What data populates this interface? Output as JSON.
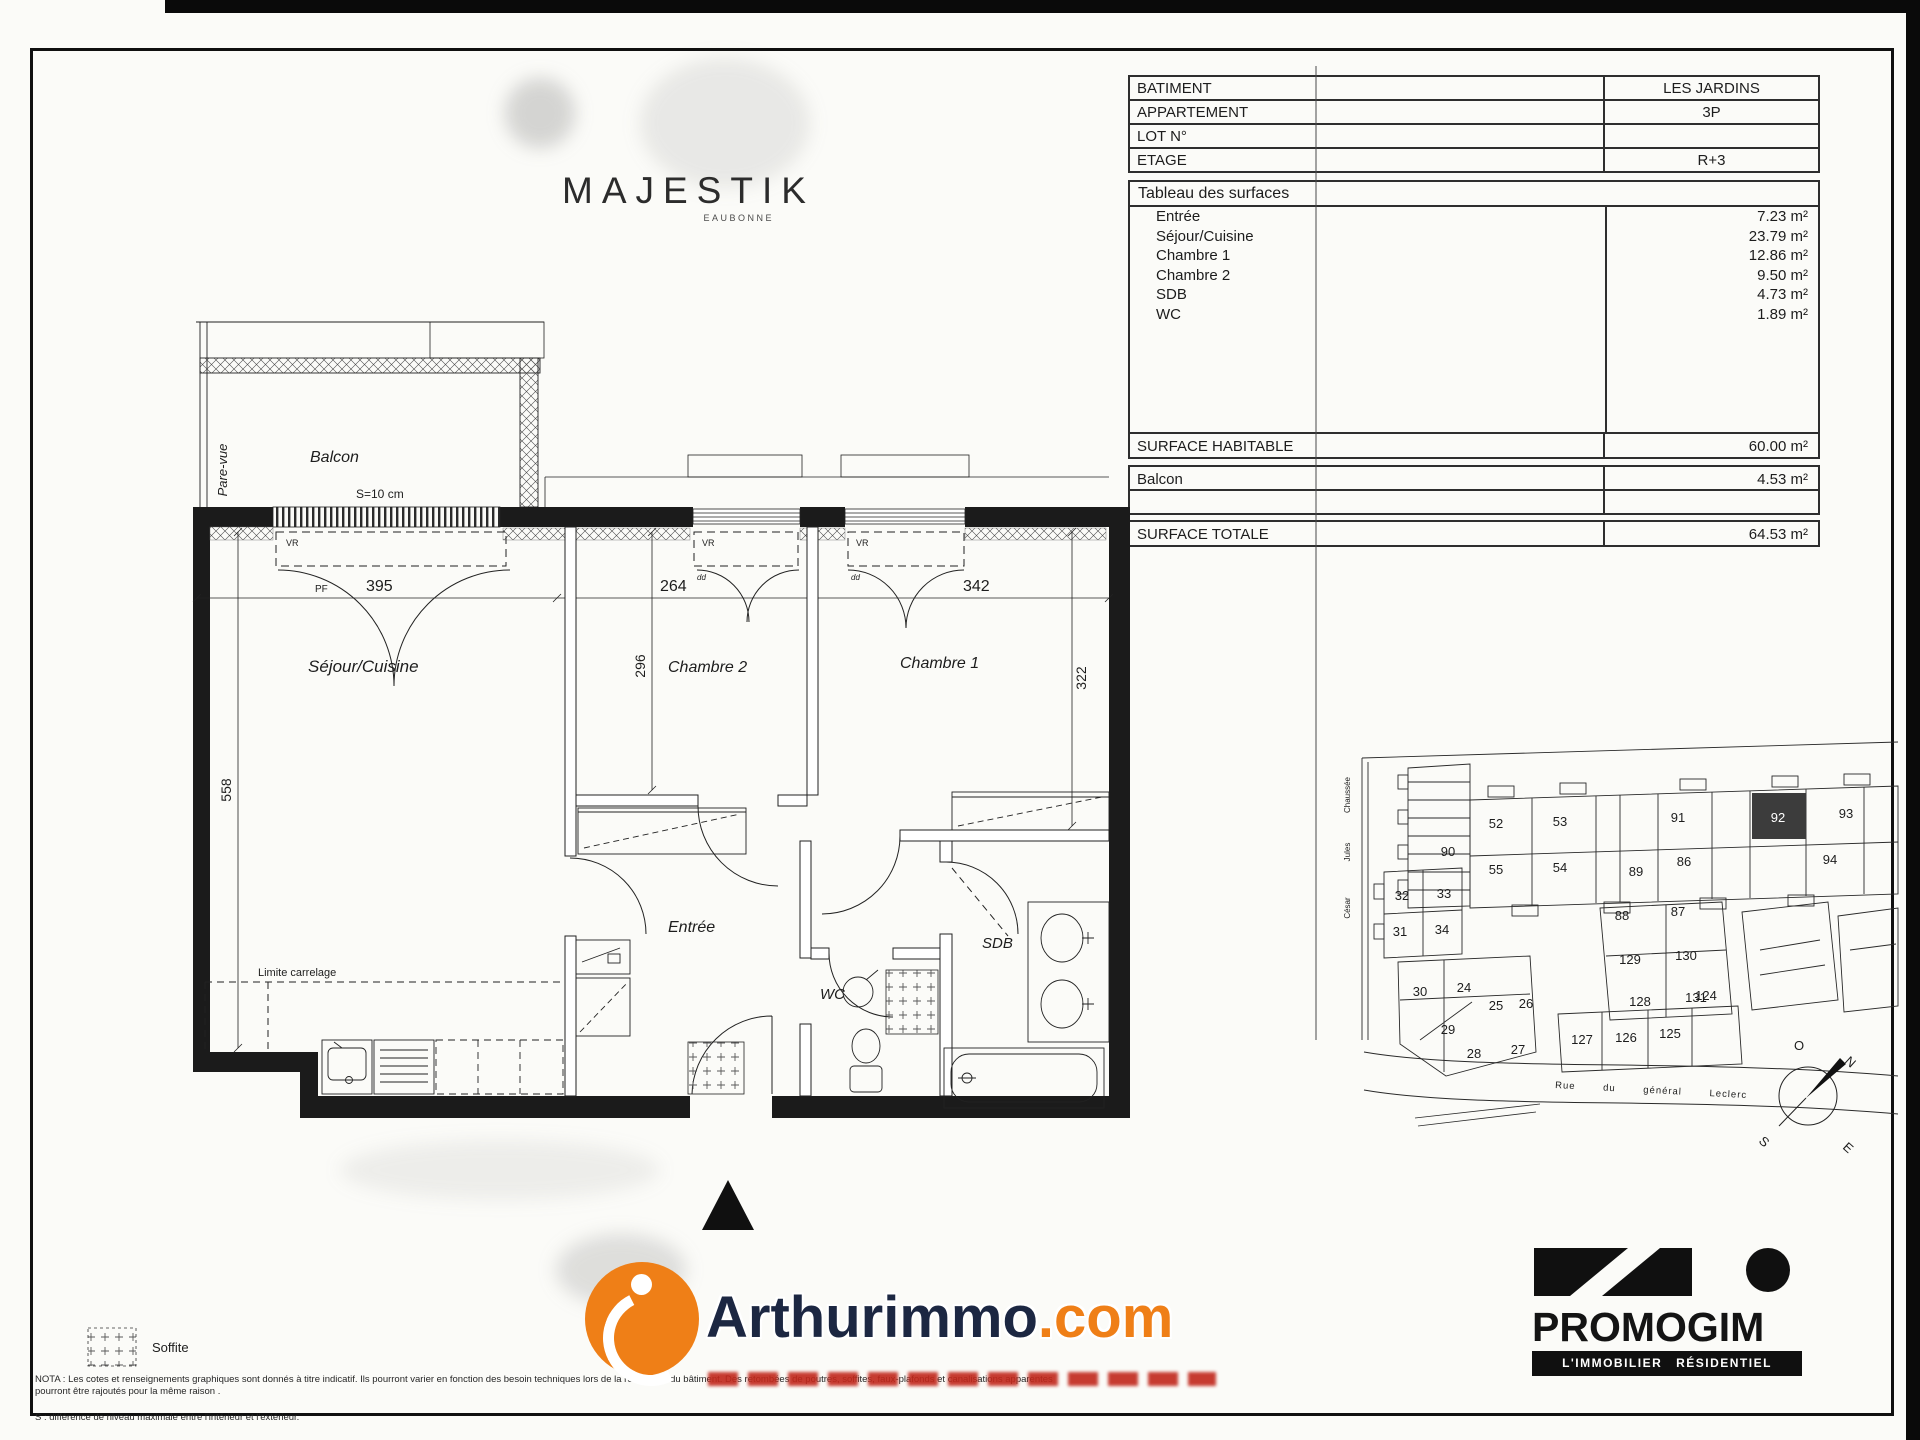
{
  "logo": {
    "title": "MAJESTIK",
    "subtitle": "EAUBONNE"
  },
  "info": {
    "rows": [
      {
        "label": "BATIMENT",
        "value": "LES JARDINS"
      },
      {
        "label": "APPARTEMENT",
        "value": "3P"
      },
      {
        "label": "LOT N°",
        "value": ""
      },
      {
        "label": "ETAGE",
        "value": "R+3"
      }
    ],
    "surfaces_title": "Tableau des surfaces",
    "surfaces": [
      {
        "label": "Entrée",
        "value": "7.23 m²"
      },
      {
        "label": "Séjour/Cuisine",
        "value": "23.79 m²"
      },
      {
        "label": "Chambre 1",
        "value": "12.86 m²"
      },
      {
        "label": "Chambre 2",
        "value": "9.50 m²"
      },
      {
        "label": "SDB",
        "value": "4.73 m²"
      },
      {
        "label": "WC",
        "value": "1.89 m²"
      }
    ],
    "habitable": {
      "label": "SURFACE HABITABLE",
      "value": "60.00 m²"
    },
    "balcon": {
      "label": "Balcon",
      "value": "4.53 m²"
    },
    "totale": {
      "label": "SURFACE TOTALE",
      "value": "64.53 m²"
    }
  },
  "floorplan": {
    "labels": {
      "balcon": "Balcon",
      "s10": "S=10 cm",
      "parevue": "Pare-vue",
      "sejour": "Séjour/Cuisine",
      "ch2": "Chambre 2",
      "ch1": "Chambre 1",
      "entree": "Entrée",
      "wc": "WC",
      "sdb": "SDB",
      "limite": "Limite carrelage",
      "d395": "395",
      "d264": "264",
      "d342": "342",
      "d296": "296",
      "d322": "322",
      "d558": "558",
      "pf": "PF",
      "vr": "VR",
      "dd": "dd"
    }
  },
  "legend": {
    "label": "Soffite"
  },
  "nota": {
    "line1": "NOTA : Les cotes et renseignements graphiques sont donnés à titre indicatif. Ils pourront varier en fonction des besoin techniques lors de la réalisation du bâtiment. Des retombées de poutres, soffites, faux-plafonds et canalisations apparentes pourront être rajoutés pour la même raison .",
    "line2": "S : différence de niveau maximale entre l'intérieur et l'extérieur."
  },
  "siteplan": {
    "side_street": [
      "Chaussée",
      "Jules",
      "César"
    ],
    "street": "Rue du général Leclerc",
    "highlight_unit": "92",
    "units": [
      {
        "n": "52",
        "x": 1496,
        "y": 828
      },
      {
        "n": "53",
        "x": 1560,
        "y": 826
      },
      {
        "n": "90",
        "x": 1448,
        "y": 856
      },
      {
        "n": "91",
        "x": 1678,
        "y": 822
      },
      {
        "n": "92",
        "x": 1778,
        "y": 822,
        "hl": true
      },
      {
        "n": "93",
        "x": 1846,
        "y": 818
      },
      {
        "n": "55",
        "x": 1496,
        "y": 874
      },
      {
        "n": "54",
        "x": 1560,
        "y": 872
      },
      {
        "n": "89",
        "x": 1636,
        "y": 876
      },
      {
        "n": "86",
        "x": 1684,
        "y": 866
      },
      {
        "n": "94",
        "x": 1830,
        "y": 864
      },
      {
        "n": "88",
        "x": 1622,
        "y": 920
      },
      {
        "n": "87",
        "x": 1678,
        "y": 916
      },
      {
        "n": "129",
        "x": 1630,
        "y": 964
      },
      {
        "n": "130",
        "x": 1686,
        "y": 960
      },
      {
        "n": "128",
        "x": 1640,
        "y": 1006
      },
      {
        "n": "131",
        "x": 1696,
        "y": 1002
      },
      {
        "n": "32",
        "x": 1402,
        "y": 900
      },
      {
        "n": "33",
        "x": 1444,
        "y": 898
      },
      {
        "n": "31",
        "x": 1400,
        "y": 936
      },
      {
        "n": "34",
        "x": 1442,
        "y": 934
      },
      {
        "n": "30",
        "x": 1420,
        "y": 996
      },
      {
        "n": "24",
        "x": 1464,
        "y": 992
      },
      {
        "n": "25",
        "x": 1496,
        "y": 1010
      },
      {
        "n": "26",
        "x": 1526,
        "y": 1008
      },
      {
        "n": "29",
        "x": 1448,
        "y": 1034
      },
      {
        "n": "28",
        "x": 1474,
        "y": 1058
      },
      {
        "n": "27",
        "x": 1518,
        "y": 1054
      },
      {
        "n": "127",
        "x": 1582,
        "y": 1044
      },
      {
        "n": "126",
        "x": 1626,
        "y": 1042
      },
      {
        "n": "125",
        "x": 1670,
        "y": 1038
      },
      {
        "n": "124",
        "x": 1706,
        "y": 1000
      }
    ],
    "compass": {
      "o": "O",
      "n": "N",
      "s": "S",
      "e": "E"
    }
  },
  "brands": {
    "arthurimmo": {
      "name": "Arthurimmo",
      "tld": ".com"
    },
    "promogim": {
      "name": "PROMOGIM",
      "tagline": "L'IMMOBILIER RÉSIDENTIEL"
    }
  },
  "colors": {
    "accent_orange": "#ef7f17",
    "dark_navy": "#1c2742",
    "red": "#c1271b"
  }
}
